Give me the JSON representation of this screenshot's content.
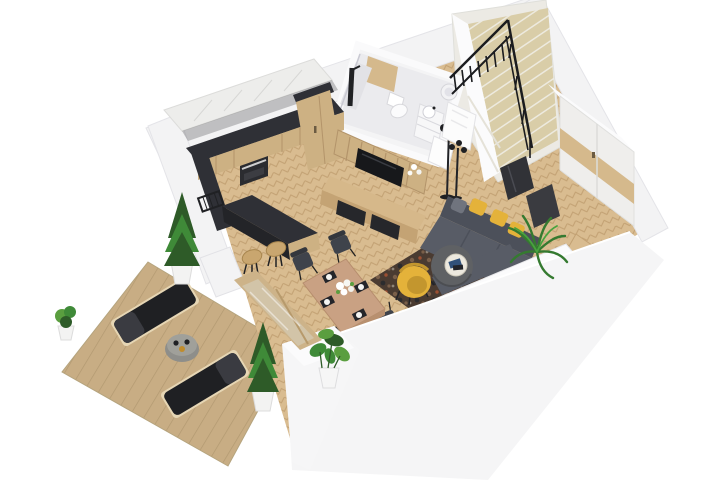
{
  "scene": {
    "type": "isometric 3d floor plan render, single storey with stairs to upper level",
    "areas": [
      {
        "name": "terrace",
        "items": [
          "wood deck",
          "sun lounger",
          "sun lounger",
          "round side table with cups",
          "potted cypress",
          "potted cypress",
          "potted shrub"
        ]
      },
      {
        "name": "kitchen",
        "items": [
          "white upper cabinets",
          "dark counter and backsplash",
          "red cookware on hob",
          "oven",
          "wood base cabinets",
          "tall pantry cabinet",
          "peninsula bar",
          "bar stool",
          "bar stool",
          "black dish rack"
        ]
      },
      {
        "name": "dining area",
        "items": [
          "wood dining table",
          "dark chair",
          "dark chair",
          "dark chair",
          "dark chair",
          "white flower centerpiece",
          "black placemats with plates",
          "potted monstera plant"
        ]
      },
      {
        "name": "living room",
        "items": [
          "grey corner sofa",
          "yellow pillows",
          "yellow armchair",
          "round pouf coffee table",
          "white tray with books",
          "patterned rug",
          "palm plant",
          "tv on slat wall panel",
          "media console with black drawers",
          "black floor lamp"
        ]
      },
      {
        "name": "bathroom",
        "items": [
          "walk-in shower with black column",
          "wall-hung toilet",
          "vanity with drawers",
          "round basin",
          "wood accent wall"
        ]
      },
      {
        "name": "entry hall",
        "items": [
          "open white door",
          "black coat stand",
          "wardrobe with wood panels",
          "dark mirror panels",
          "entry floor recess"
        ]
      },
      {
        "name": "staircase",
        "items": [
          "winder staircase",
          "black metal railing",
          "beige treads"
        ]
      }
    ]
  },
  "colors": {
    "bg": "#ffffff",
    "wall": "#f3f3f4",
    "wallBright": "#fbfbfc",
    "wallShade": "#e7e7ea",
    "floor": "#d9bc90",
    "floorLine": "#c2a173",
    "deck": "#c8ad84",
    "deckLine": "#b29971",
    "dark": "#2f3036",
    "wood": "#cdb183",
    "woodDark": "#b3946a",
    "accentWood": "#d5b98c",
    "tile": "#ebebee",
    "sofa": "#585c66",
    "sofaDark": "#4c505a",
    "sofaLight": "#646873",
    "yellow": "#e4b23a",
    "yellowDark": "#c3962e",
    "chair": "#3f434b",
    "tableWood": "#c9a183",
    "rug": "#4a3b31",
    "rugSpot1": "#7a5f49",
    "rugSpot2": "#9c4f32",
    "rugSpot3": "#2c2c2e",
    "plant": "#3f8a38",
    "plantDark": "#2e5b28",
    "plantLight": "#5a9e3f",
    "stairTread": "#d9cda8",
    "stairLight": "#edeadf",
    "black": "#1f2023",
    "tv": "#17181b",
    "pouf": "#5f6164",
    "tray": "#ece8de",
    "glass": "#d2c4a8",
    "frameWood": "#cdb389",
    "red": "#b23429",
    "white": "#ffffff"
  }
}
